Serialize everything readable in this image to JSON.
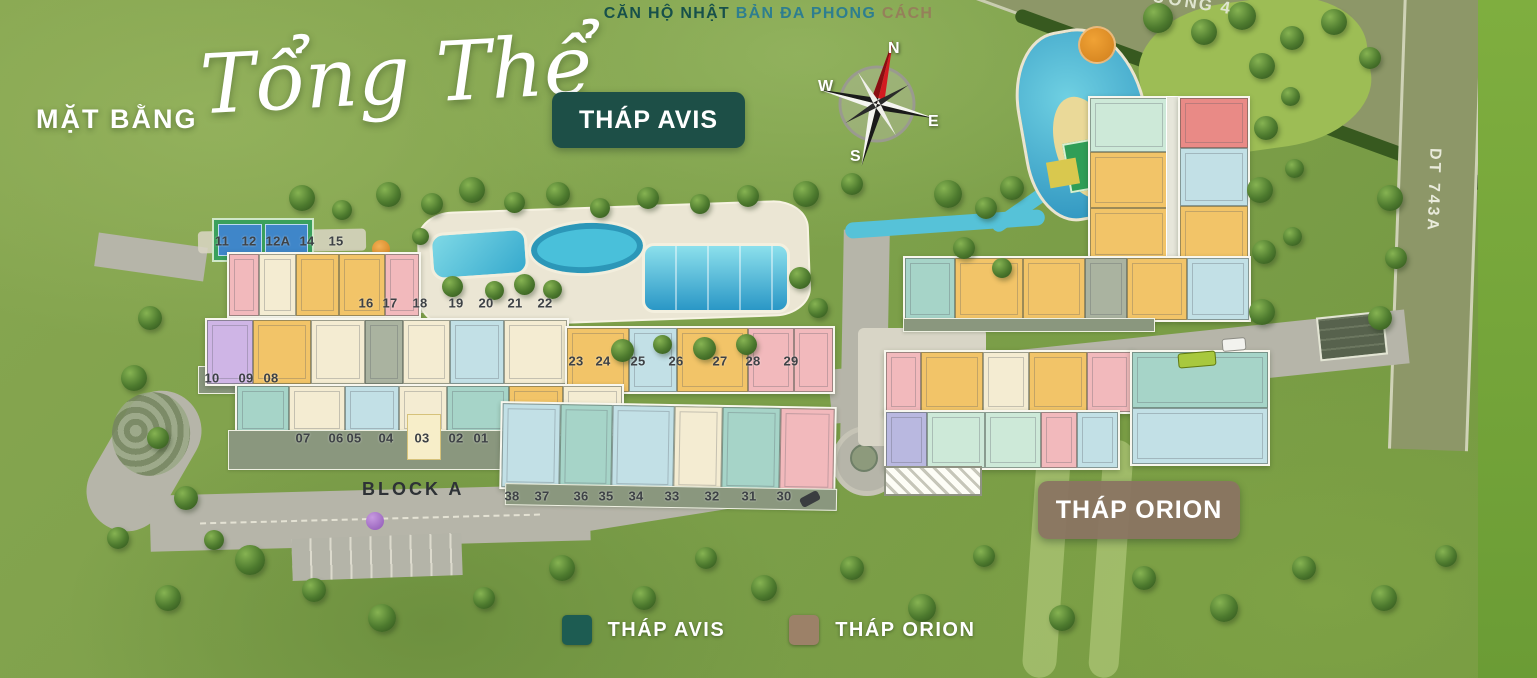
{
  "tagline": {
    "segments": [
      {
        "text": "CĂN HỘ NHẬT ",
        "color": "#17504a"
      },
      {
        "text": "BẢN ĐA PHONG ",
        "color": "#2e7e8f"
      },
      {
        "text": "CÁCH",
        "color": "#95805a"
      }
    ]
  },
  "title": {
    "prefix": "MẶT BẰNG",
    "script": "Tổng Thể"
  },
  "badges": {
    "avis": "THÁP AVIS",
    "orion": "THÁP ORION"
  },
  "compass": {
    "n": "N",
    "w": "W",
    "e": "E",
    "s": "S"
  },
  "roads": {
    "right_road_label": "DT 743A",
    "top_road_label_partial": "ƯƠNG 4",
    "block_label": "BLOCK A"
  },
  "legend": {
    "items": [
      {
        "label": "THÁP AVIS",
        "color": "#1d5c52"
      },
      {
        "label": "THÁP ORION",
        "color": "#9c8168"
      }
    ]
  },
  "unit_labels": [
    {
      "t": "11",
      "x": 222,
      "y": 241
    },
    {
      "t": "12",
      "x": 249,
      "y": 241
    },
    {
      "t": "12A",
      "x": 278,
      "y": 241
    },
    {
      "t": "14",
      "x": 307,
      "y": 241
    },
    {
      "t": "15",
      "x": 336,
      "y": 241
    },
    {
      "t": "16",
      "x": 366,
      "y": 303
    },
    {
      "t": "17",
      "x": 390,
      "y": 303
    },
    {
      "t": "18",
      "x": 420,
      "y": 303
    },
    {
      "t": "19",
      "x": 456,
      "y": 303
    },
    {
      "t": "20",
      "x": 486,
      "y": 303
    },
    {
      "t": "21",
      "x": 515,
      "y": 303
    },
    {
      "t": "22",
      "x": 545,
      "y": 303
    },
    {
      "t": "23",
      "x": 576,
      "y": 361
    },
    {
      "t": "24",
      "x": 603,
      "y": 361
    },
    {
      "t": "25",
      "x": 638,
      "y": 361
    },
    {
      "t": "26",
      "x": 676,
      "y": 361
    },
    {
      "t": "27",
      "x": 720,
      "y": 361
    },
    {
      "t": "28",
      "x": 753,
      "y": 361
    },
    {
      "t": "29",
      "x": 791,
      "y": 361
    },
    {
      "t": "10",
      "x": 212,
      "y": 378
    },
    {
      "t": "09",
      "x": 246,
      "y": 378
    },
    {
      "t": "08",
      "x": 271,
      "y": 378
    },
    {
      "t": "07",
      "x": 303,
      "y": 438
    },
    {
      "t": "06",
      "x": 336,
      "y": 438
    },
    {
      "t": "05",
      "x": 354,
      "y": 438
    },
    {
      "t": "04",
      "x": 386,
      "y": 438
    },
    {
      "t": "03",
      "x": 422,
      "y": 438
    },
    {
      "t": "02",
      "x": 456,
      "y": 438
    },
    {
      "t": "01",
      "x": 481,
      "y": 438
    },
    {
      "t": "38",
      "x": 512,
      "y": 496
    },
    {
      "t": "37",
      "x": 542,
      "y": 496
    },
    {
      "t": "36",
      "x": 581,
      "y": 496
    },
    {
      "t": "35",
      "x": 606,
      "y": 496
    },
    {
      "t": "34",
      "x": 636,
      "y": 496
    },
    {
      "t": "33",
      "x": 672,
      "y": 496
    },
    {
      "t": "32",
      "x": 712,
      "y": 496
    },
    {
      "t": "31",
      "x": 749,
      "y": 496
    },
    {
      "t": "30",
      "x": 784,
      "y": 496
    }
  ],
  "decor": {
    "trees": [
      [
        302,
        198,
        26
      ],
      [
        342,
        210,
        20
      ],
      [
        388,
        194,
        25
      ],
      [
        432,
        204,
        22
      ],
      [
        472,
        190,
        26
      ],
      [
        514,
        202,
        21
      ],
      [
        558,
        194,
        24
      ],
      [
        600,
        208,
        20
      ],
      [
        648,
        198,
        22
      ],
      [
        700,
        204,
        20
      ],
      [
        748,
        196,
        22
      ],
      [
        806,
        194,
        26
      ],
      [
        852,
        184,
        22
      ],
      [
        948,
        194,
        28
      ],
      [
        986,
        208,
        22
      ],
      [
        1012,
        188,
        24
      ],
      [
        452,
        286,
        21
      ],
      [
        494,
        290,
        19
      ],
      [
        524,
        284,
        21
      ],
      [
        552,
        289,
        19
      ],
      [
        622,
        350,
        23
      ],
      [
        662,
        344,
        19
      ],
      [
        704,
        348,
        23
      ],
      [
        746,
        344,
        21
      ],
      [
        1262,
        66,
        26
      ],
      [
        1266,
        128,
        24
      ],
      [
        1260,
        190,
        26
      ],
      [
        1264,
        252,
        24
      ],
      [
        1262,
        312,
        26
      ],
      [
        1290,
        96,
        19
      ],
      [
        1294,
        168,
        19
      ],
      [
        1292,
        236,
        19
      ],
      [
        1158,
        18,
        30
      ],
      [
        1204,
        32,
        26
      ],
      [
        1242,
        16,
        28
      ],
      [
        1292,
        38,
        24
      ],
      [
        1334,
        22,
        26
      ],
      [
        1370,
        58,
        22
      ],
      [
        1390,
        198,
        26
      ],
      [
        1396,
        258,
        22
      ],
      [
        1380,
        318,
        24
      ],
      [
        150,
        318,
        24
      ],
      [
        134,
        378,
        26
      ],
      [
        158,
        438,
        22
      ],
      [
        186,
        498,
        24
      ],
      [
        214,
        540,
        20
      ],
      [
        250,
        560,
        30
      ],
      [
        314,
        590,
        24
      ],
      [
        382,
        618,
        28
      ],
      [
        484,
        598,
        22
      ],
      [
        562,
        568,
        26
      ],
      [
        644,
        598,
        24
      ],
      [
        706,
        558,
        22
      ],
      [
        764,
        588,
        26
      ],
      [
        852,
        568,
        24
      ],
      [
        922,
        608,
        28
      ],
      [
        984,
        556,
        22
      ],
      [
        1062,
        618,
        26
      ],
      [
        1144,
        578,
        24
      ],
      [
        1224,
        608,
        28
      ],
      [
        1304,
        568,
        24
      ],
      [
        1384,
        598,
        26
      ],
      [
        1446,
        556,
        22
      ],
      [
        168,
        598,
        26
      ],
      [
        118,
        538,
        22
      ],
      [
        420,
        236,
        17
      ],
      [
        800,
        278,
        22
      ],
      [
        818,
        308,
        20
      ],
      [
        964,
        248,
        22
      ],
      [
        1002,
        268,
        20
      ]
    ]
  }
}
